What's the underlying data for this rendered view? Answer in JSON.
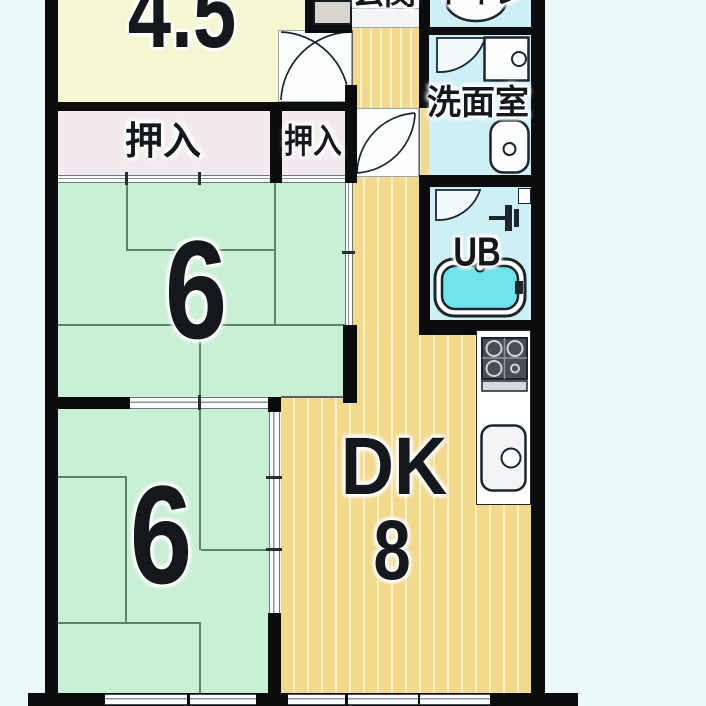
{
  "title": "2DK apartment floor plan",
  "colors": {
    "outside": "#edf8fb",
    "wall": "#0b0c0e",
    "room45-fill": "#f5f7d0",
    "closet-fill": "#f3eaf0",
    "tatami": "#c9efd4",
    "tatami-line": "#5d8468",
    "dk": "#f2d98b",
    "dk-stripe": "#f9f0c8",
    "wet": "#cdeff5",
    "tub": "#6ee3ea",
    "rail-line": "#8b959d",
    "icon": "#1c252e"
  },
  "rooms": {
    "room45": {
      "label": "4.5"
    },
    "genkan": {
      "label": "玄関"
    },
    "toilet": {
      "label": "トイレ"
    },
    "washroom": {
      "label": "洗面室"
    },
    "bath": {
      "label": "UB"
    },
    "closet_main": {
      "label": "押入"
    },
    "closet_small": {
      "label": "押入"
    },
    "tatami_upper": {
      "label": "6"
    },
    "tatami_lower": {
      "label": "6"
    },
    "dk": {
      "label": "DK",
      "size": "8"
    }
  }
}
